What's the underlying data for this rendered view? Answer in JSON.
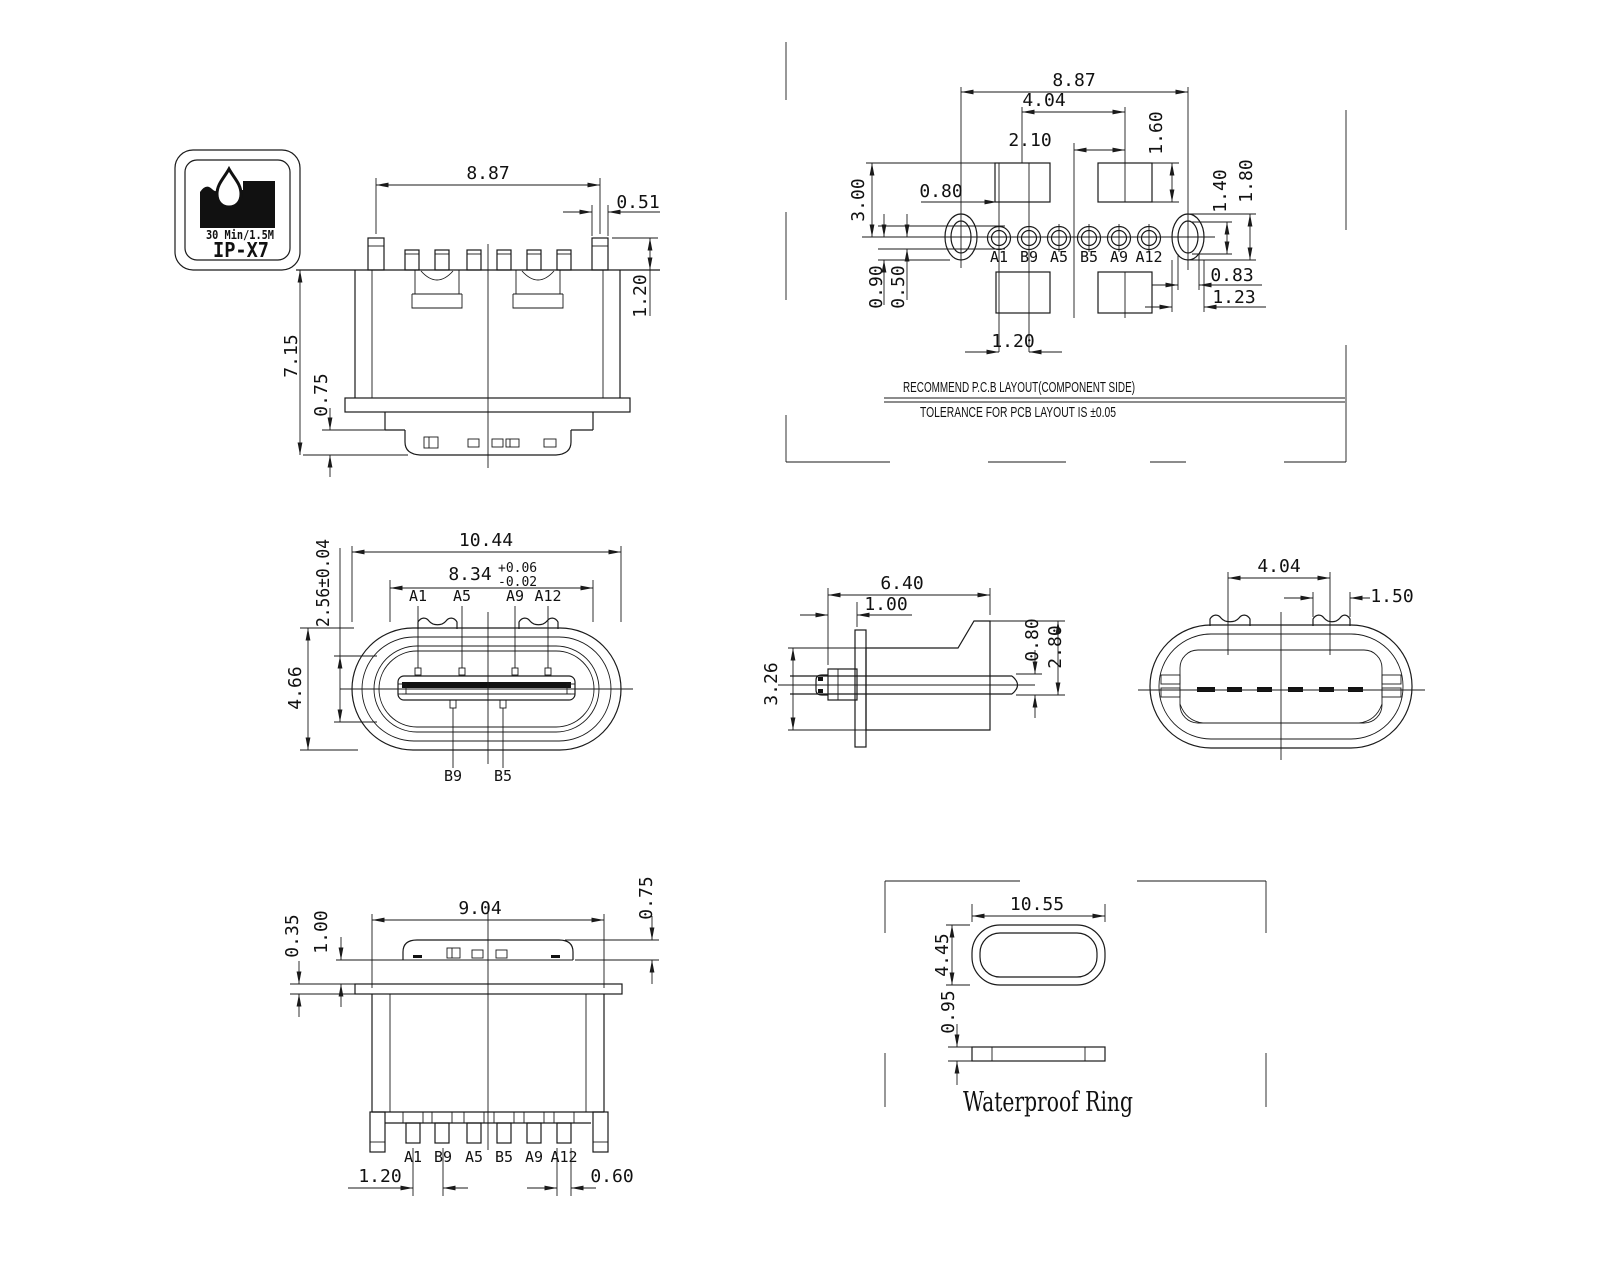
{
  "badge": {
    "duration": "30 Min/1.5M",
    "rating": "IP-X7"
  },
  "notes": {
    "line1": "RECOMMEND P.C.B LAYOUT(COMPONENT SIDE)",
    "line2": "TOLERANCE FOR PCB LAYOUT IS ±0.05"
  },
  "views": {
    "front_top": {
      "dims": {
        "width": "8.87",
        "pin_width": "0.51",
        "pin_height": "1.20",
        "height": "7.15",
        "bottom_lip": "0.75"
      }
    },
    "pcb": {
      "pins": [
        "A1",
        "B9",
        "A5",
        "B5",
        "A9",
        "A12"
      ],
      "dims": {
        "hole_span": "8.87",
        "pad_span": "4.04",
        "pad_offset": "2.10",
        "pad_height": "1.60",
        "pad_rise": "3.00",
        "pin_offset": "0.80",
        "oval_drop": "0.90",
        "pin_drop": "0.50",
        "pin_pitch": "1.20",
        "hole_inner_h": "1.40",
        "hole_outer_h": "1.80",
        "hole_inner_w": "0.83",
        "hole_outer_w": "1.23"
      }
    },
    "face": {
      "pins_top": [
        "A1",
        "A5",
        "A9",
        "A12"
      ],
      "pins_bottom": [
        "B9",
        "B5"
      ],
      "dims": {
        "width": "10.44",
        "tongue_width": "8.34",
        "tol_plus": "+0.06",
        "tol_minus": "-0.02",
        "inner_height": "2.56±0.04",
        "height": "4.66"
      }
    },
    "side": {
      "dims": {
        "depth": "6.40",
        "flange_offset": "1.00",
        "height": "3.26",
        "tongue_gap": "0.80",
        "cavity": "2.80"
      }
    },
    "rear": {
      "dims": {
        "tab_span": "4.04",
        "tab_width": "1.50"
      }
    },
    "bottom": {
      "pins": [
        "A1",
        "B9",
        "A5",
        "B5",
        "A9",
        "A12"
      ],
      "dims": {
        "width": "9.04",
        "cap_height": "0.75",
        "flange": "0.35",
        "cap_offset": "1.00",
        "pin_pitch": "1.20",
        "pin_width": "0.60"
      }
    },
    "ring": {
      "label": "Waterproof Ring",
      "dims": {
        "width": "10.55",
        "height": "4.45",
        "thickness": "0.95"
      }
    }
  }
}
